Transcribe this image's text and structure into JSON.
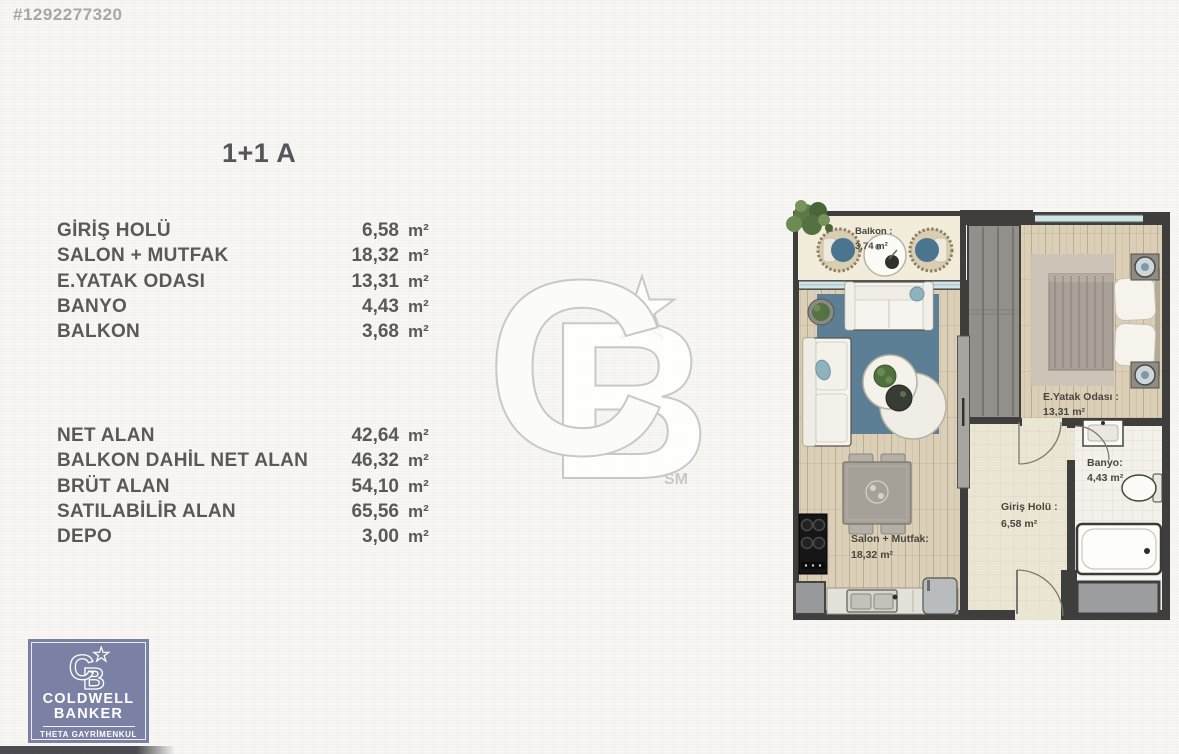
{
  "listing": {
    "id": "#1292277320"
  },
  "unit": {
    "title": "1+1 A"
  },
  "rooms": {
    "rows": [
      {
        "label": "GİRİŞ HOLÜ",
        "value": "6,58",
        "unit": "m²"
      },
      {
        "label": "SALON + MUTFAK",
        "value": "18,32",
        "unit": "m²"
      },
      {
        "label": "E.YATAK ODASI",
        "value": "13,31",
        "unit": "m²"
      },
      {
        "label": "BANYO",
        "value": "4,43",
        "unit": "m²"
      },
      {
        "label": "BALKON",
        "value": "3,68",
        "unit": "m²"
      }
    ]
  },
  "summary": {
    "rows": [
      {
        "label": "NET ALAN",
        "value": "42,64",
        "unit": "m²"
      },
      {
        "label": "BALKON DAHİL NET ALAN",
        "value": "46,32",
        "unit": "m²"
      },
      {
        "label": "BRÜT ALAN",
        "value": "54,10",
        "unit": "m²"
      },
      {
        "label": "SATILABİLİR ALAN",
        "value": "65,56",
        "unit": "m²"
      },
      {
        "label": "DEPO",
        "value": "3,00",
        "unit": "m²"
      }
    ]
  },
  "floorplan": {
    "balcony": {
      "name": "Balkon :",
      "area": "3,74 m²"
    },
    "living": {
      "name": "Salon + Mutfak:",
      "area": "18,32 m²"
    },
    "bedroom": {
      "name": "E.Yatak Odası :",
      "area": "13,31 m²"
    },
    "hall": {
      "name": "Giriş Holü :",
      "area": "6,58 m²"
    },
    "bath": {
      "name": "Banyo:",
      "area": "4,43 m²"
    }
  },
  "watermark": {
    "c": "C",
    "b": "B",
    "mark": "SM"
  },
  "agency": {
    "c": "C",
    "b": "B",
    "line1": "COLDWELL",
    "line2": "BANKER",
    "line3": "THETA GAYRİMENKUL"
  },
  "colors": {
    "wall": "#3f3e3c",
    "wood_floor": "#dccfb7",
    "rug": "#5d7f95",
    "window": "#cfe4e6",
    "brand_box": "#7b81a4",
    "text": "#595a55",
    "muted": "#a6a6a6"
  }
}
